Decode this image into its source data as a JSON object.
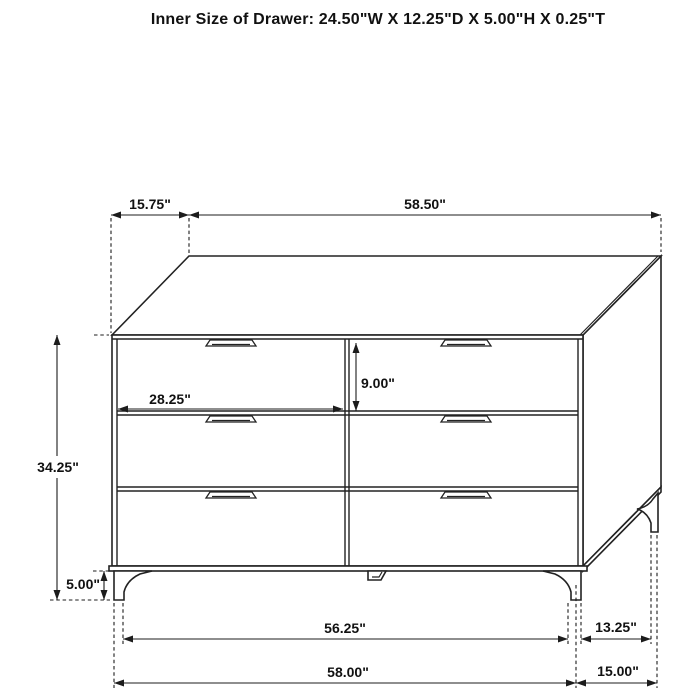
{
  "title": "Inner Size of Drawer: 24.50\"W X 12.25\"D X 5.00\"H X 0.25\"T",
  "colors": {
    "line": "#222222",
    "background": "#ffffff",
    "text": "#111111"
  },
  "dresser": {
    "drawer_rows": 3,
    "drawer_columns": 2,
    "handle_count": 6
  },
  "dimension_labels": {
    "top_depth": "15.75\"",
    "top_width": "58.50\"",
    "overall_height": "34.25\"",
    "drawer_front_width": "28.25\"",
    "drawer_front_height": "9.00\"",
    "leg_height": "5.00\"",
    "foot_span_width": "56.25\"",
    "overall_width": "58.00\"",
    "foot_span_depth": "13.25\"",
    "overall_depth": "15.00\""
  },
  "inner_drawer_size": {
    "width": "24.50\"W",
    "depth": "12.25\"D",
    "height": "5.00\"H",
    "thickness": "0.25\"T"
  }
}
